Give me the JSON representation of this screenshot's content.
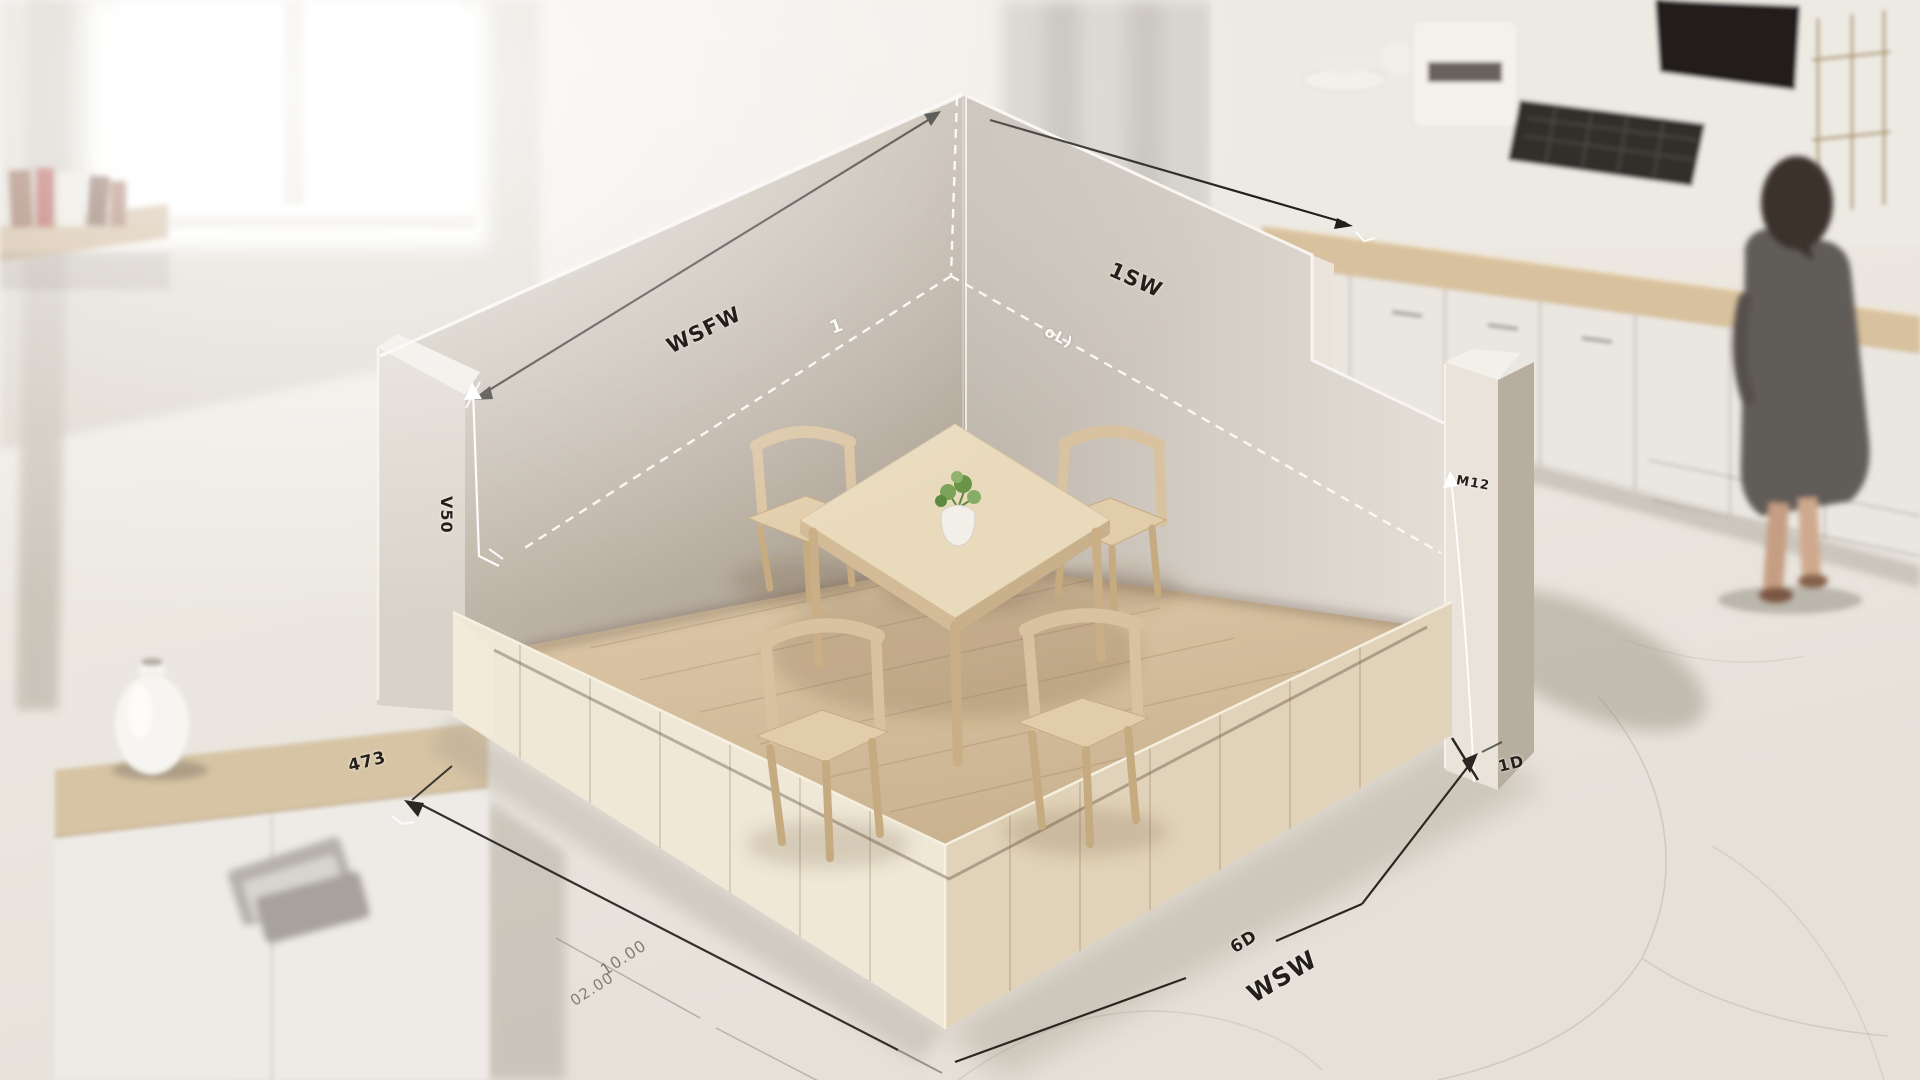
{
  "annotations": {
    "left_wall_label": "WSFW",
    "right_wall_label": "1SW",
    "left_height_label": "V50",
    "pillar_label": "M12",
    "corner_label": "1",
    "right_dash_label": "oL)",
    "floor_left_label": "473",
    "floor_left_sketch_1": "10.00",
    "floor_left_sketch_2": "02.00",
    "floor_right_small_label": "6D",
    "floor_right_label": "WSW",
    "floor_right_end_label": "1D"
  },
  "colors": {
    "bg": "#eae6e0",
    "ink": "#241f19",
    "wall_left": "#b7ada0",
    "wall_right": "#d8d1c8",
    "wood_floor": "#d5c1a3",
    "wood_trim": "#e9dfc9",
    "table_top": "#e9dabc",
    "chair_wood": "#d9c29f",
    "plant_green": "#7ca35a",
    "annotation_white": "#fbfaf6"
  }
}
